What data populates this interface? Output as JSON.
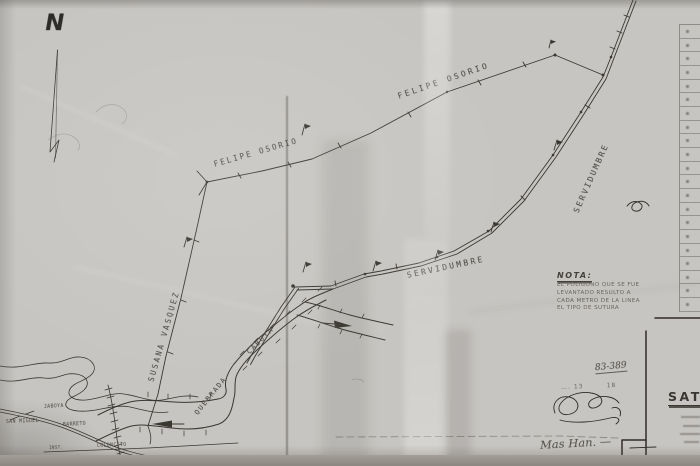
{
  "map": {
    "north_label": "N",
    "labels": {
      "owner_upper": "FELIPE OSORIO",
      "owner_lower": "FELIPE OSORIO",
      "servidumbre_right": "SERVIDUMBRE",
      "servidumbre_lower": "SERVIDUMBRE",
      "owner_left": "SUSANA VASQUEZ",
      "quebrada_word1": "QUEBRADA",
      "quebrada_word2": "CABUYA"
    },
    "inset_labels": {
      "jaboya": "JABOYA",
      "san_miguel": "SAN MIGUEL",
      "barreto": "BARRETO",
      "coloncito": "COLONCITO",
      "inst": "INST."
    },
    "nota": {
      "title": "NOTA:",
      "lines": [
        "EL POLIGONO QUE SE FUE",
        "LEVANTADO RESULTO A",
        "CADA METRO DE LA LINEA",
        "EL TIPO DE SUTURA"
      ]
    },
    "title_block": {
      "sheet_no": "83-389",
      "annotation": "…. 13        18",
      "big_label": "SATO",
      "signature": "Mas Han. —"
    },
    "side_table": {
      "row_count": 21
    },
    "colors": {
      "paper": "#c7c5c1",
      "ink": "#3a3733",
      "frame": "#302e2b",
      "bottom_strip": "#8b867f"
    }
  }
}
